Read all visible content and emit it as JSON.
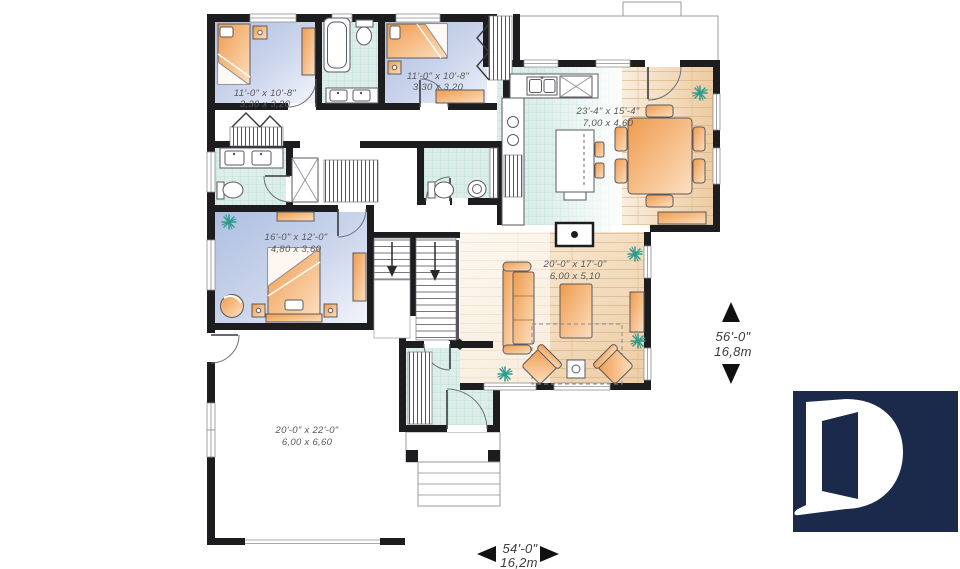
{
  "plan": {
    "type": "floor-plan",
    "rooms": [
      {
        "id": "bedroom-1",
        "imperial": "11'-0\" x 10'-8\"",
        "metric": "3,30 x 3,20"
      },
      {
        "id": "bedroom-2",
        "imperial": "11'-0\" x 10'-8\"",
        "metric": "3,30 x 3,20"
      },
      {
        "id": "kitchen-dining",
        "imperial": "23'-4\" x 15'-4\"",
        "metric": "7,00 x 4,60"
      },
      {
        "id": "master-bedroom",
        "imperial": "16'-0\" x 12'-0\"",
        "metric": "4,80 x 3,60"
      },
      {
        "id": "living-room",
        "imperial": "20'-0\" x 17'-0\"",
        "metric": "6,00 x 5,10"
      },
      {
        "id": "garage",
        "imperial": "20'-0\" x 22'-0\"",
        "metric": "6,00 x 6,60"
      }
    ],
    "overall": {
      "depth_imperial": "56'-0\"",
      "depth_metric": "16,8m",
      "width_imperial": "54'-0\"",
      "width_metric": "16,2m"
    }
  },
  "colors": {
    "wall": "#1d1d20",
    "text": "#58585a",
    "dimtext": "#3c3c3e",
    "line": "#5a5a60",
    "plant": "#2d9c8c",
    "accent_orange": "#f09c4e",
    "floor_blue": "#b3c2e2",
    "tile_teal": "#ddeeea",
    "wood_tan": "#e2a866",
    "logo_bg": "#1b2a4b"
  }
}
